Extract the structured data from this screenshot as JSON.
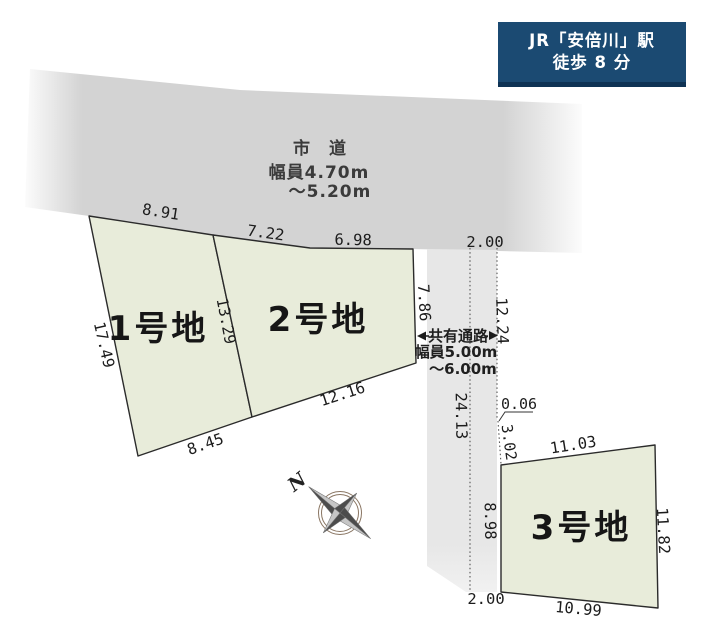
{
  "station_badge": {
    "line1": "JR「安倍川」駅",
    "line2": "徒歩 8 分",
    "bg_color": "#1b4a72",
    "border_color": "#0f3354",
    "text_color": "#ffffff"
  },
  "road": {
    "name": "市　道",
    "width_line1": "幅員4.70m",
    "width_line2": "～5.20m",
    "fill": "#d3d3d3"
  },
  "passage": {
    "name": "共有通路",
    "width_line1": "幅員5.00m",
    "width_line2": "～6.00m",
    "fill": "#e7e7e7",
    "arrow_color": "#1c1c1c"
  },
  "plots": [
    {
      "name": "1号地",
      "fill": "#e8ecda",
      "dim_top": "8.91",
      "dim_left": "17.49",
      "dim_right": "13.29",
      "dim_bottom": "8.45"
    },
    {
      "name": "2号地",
      "fill": "#e8ecda",
      "dim_top_left": "7.22",
      "dim_top_right": "6.98",
      "dim_right": "7.86",
      "dim_bottom": "12.16"
    },
    {
      "name": "3号地",
      "fill": "#e8ecda",
      "dim_top": "11.03",
      "dim_right": "11.82",
      "dim_bottom": "10.99",
      "dim_left": "8.98"
    }
  ],
  "measurements": {
    "passage_top_width": "2.00",
    "passage_right_upper": "12.24",
    "passage_left_length": "24.13",
    "offset": "0.06",
    "passage_right_lower": "3.02",
    "passage_bottom_width": "2.00"
  },
  "compass": {
    "north_label": "N"
  },
  "colors": {
    "plot_outline": "#2b2b2b",
    "dotted_line": "#555555",
    "compass_ring": "#8a7663",
    "compass_dark": "#4c4c4c",
    "compass_light": "#c6c6c6"
  }
}
